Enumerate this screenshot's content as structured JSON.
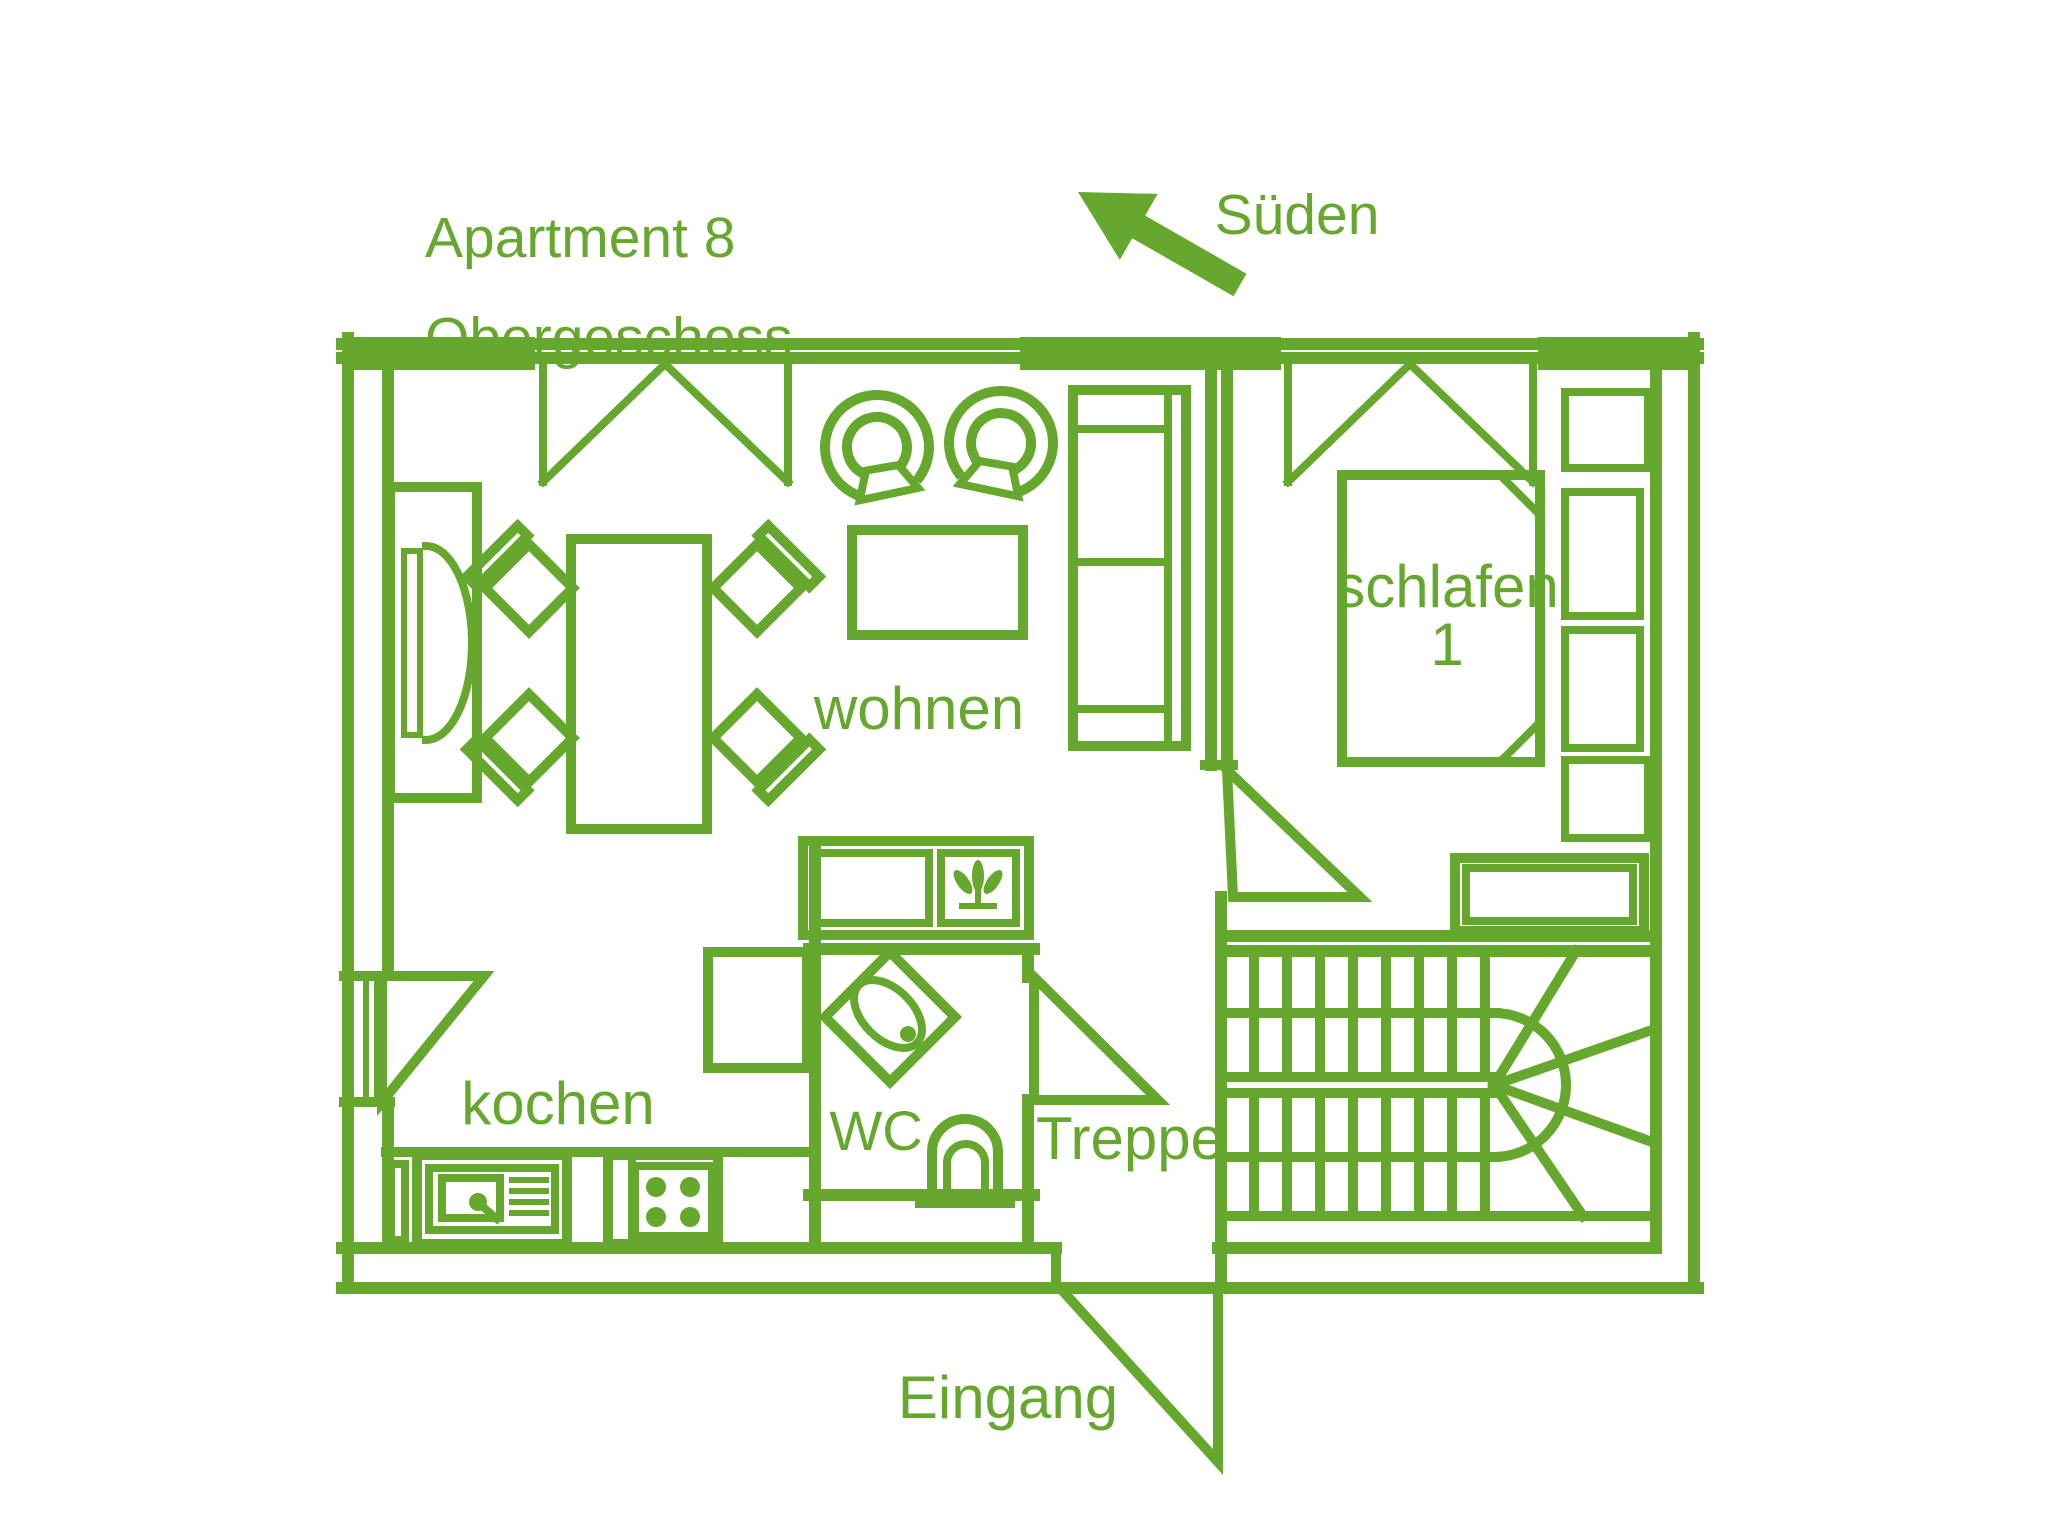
{
  "colors": {
    "line_green": "#66a82e",
    "background": "#ffffff"
  },
  "header": {
    "title_line1": "Apartment 8",
    "title_line2": "Obergeschoss"
  },
  "compass": {
    "label": "Süden",
    "arrow_direction": "up-left"
  },
  "rooms": {
    "living": {
      "label": "wohnen"
    },
    "bedroom": {
      "label": "schlafen",
      "number": "1"
    },
    "kitchen": {
      "label": "kochen"
    },
    "wc": {
      "label": "WC"
    },
    "stairs": {
      "label": "Treppe"
    },
    "entrance": {
      "label": "Eingang"
    }
  }
}
